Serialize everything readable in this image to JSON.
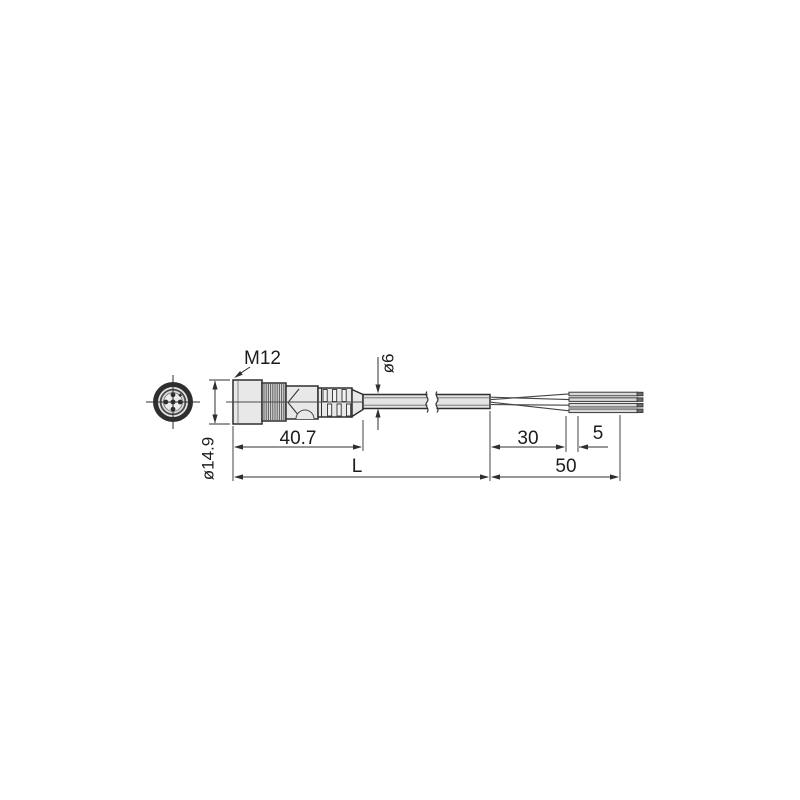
{
  "palette": {
    "line": "#2f2f2f",
    "fill": "#e8e8e8",
    "text": "#1c1c1c",
    "bg": "#ffffff"
  },
  "drawing": {
    "labels": {
      "thread_size": "M12",
      "cable_diameter": "ø6",
      "connector_diameter": "ø14.9",
      "connector_length": "40.7",
      "cable_length": "L",
      "fanout_length": "30",
      "tip_length": "5",
      "stripped_length": "50"
    }
  }
}
